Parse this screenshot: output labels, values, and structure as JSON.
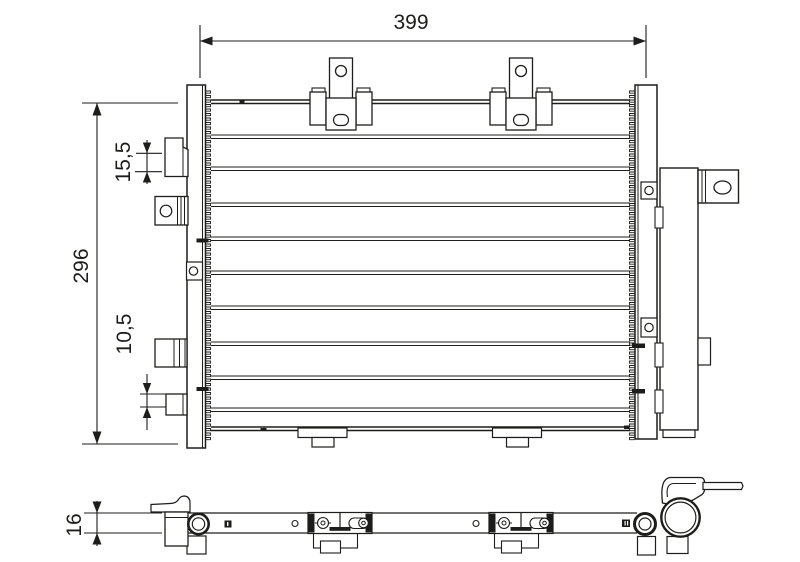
{
  "drawing": {
    "type": "technical-line-drawing",
    "subject": "automotive condenser - front view and bottom view",
    "background_color": "#ffffff",
    "line_color": "#1d1d1b",
    "dimensions": {
      "overall_width": {
        "label": "399"
      },
      "overall_height": {
        "label": "296"
      },
      "upper_fitting_offset": {
        "label": "15,5"
      },
      "lower_fitting_offset": {
        "label": "10,5"
      },
      "depth": {
        "label": "16"
      }
    }
  }
}
